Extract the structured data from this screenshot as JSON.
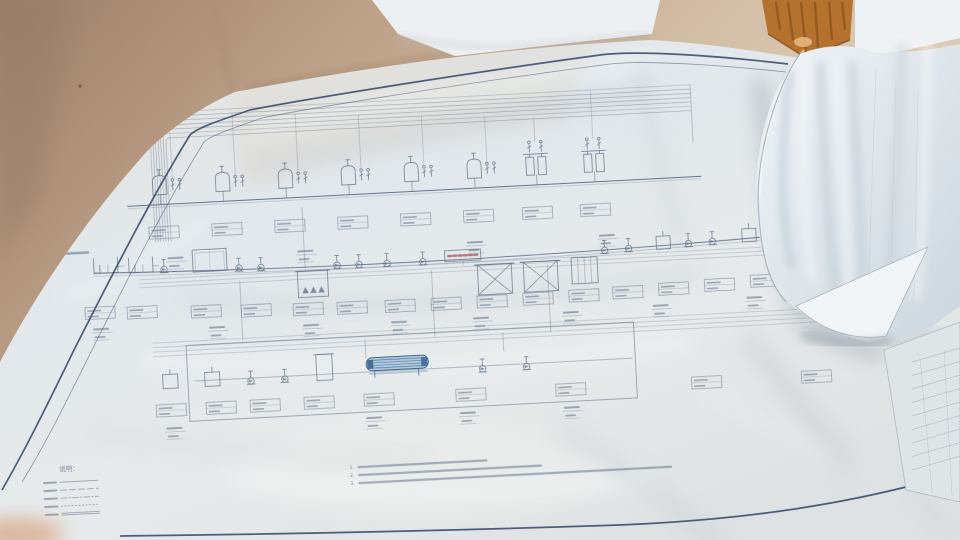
{
  "scene": {
    "description": "Photograph of a large process-flow blueprint (wastewater treatment PFD) spread on a tan surface, with folded drawing sheets draped on the right side",
    "colors": {
      "wall-dark": "#9c7f69",
      "wall-light": "#e2d2bc",
      "wood-patch": "#b5722e",
      "paper": "#e4e9ec",
      "paper-shadow": "#b9c4cc",
      "border-navy": "#3d4e6e",
      "ink": "#5a6a82",
      "accent-red": "#b05454",
      "accent-blue": "#2e5c8a",
      "machine-fill": "#a9c6db",
      "drape-paper": "#e9eef2",
      "title-sheet": "#dfe4e7"
    }
  },
  "legend": {
    "header": "说明：",
    "items": [
      {
        "label_legible": false,
        "line_style": "solid"
      },
      {
        "label_legible": false,
        "line_style": "dashed"
      },
      {
        "label_legible": false,
        "line_style": "dash-dot"
      },
      {
        "label_legible": false,
        "line_style": "dotted"
      },
      {
        "label_legible": false,
        "line_style": "double"
      }
    ]
  },
  "notes": {
    "items": [
      {
        "number": "1.",
        "length": 128
      },
      {
        "number": "2.",
        "length": 182
      },
      {
        "number": "3.",
        "length": 312
      }
    ]
  },
  "title_block": {
    "row_count": 9
  },
  "diagram": {
    "rotation_deg": -3,
    "top_row": {
      "baseline": 178,
      "units": [
        {
          "x": 158,
          "type": "dome"
        },
        {
          "x": 221,
          "type": "dome"
        },
        {
          "x": 284,
          "type": "dome"
        },
        {
          "x": 347,
          "type": "dome"
        },
        {
          "x": 410,
          "type": "dome"
        },
        {
          "x": 473,
          "type": "dome"
        },
        {
          "x": 532,
          "type": "columns"
        },
        {
          "x": 590,
          "type": "columns"
        }
      ],
      "underline_labels_x": [
        168,
        298,
        468,
        600
      ],
      "header_pipes": {
        "count": 7,
        "y": 96,
        "gap": 4.3,
        "x2": 700,
        "corner_x": 158,
        "corner_gap": 2.6,
        "y_bottom": 225
      },
      "main_line_y": 188
    },
    "mid_row": {
      "baseline": 252,
      "elements": [
        {
          "x": 58,
          "type": "microtext"
        },
        {
          "x": 95,
          "type": "basin"
        },
        {
          "x": 130,
          "type": "basin"
        },
        {
          "x": 165,
          "type": "pump"
        },
        {
          "x": 194,
          "type": "recttank"
        },
        {
          "x": 240,
          "type": "pump"
        },
        {
          "x": 262,
          "type": "pump"
        },
        {
          "x": 298,
          "type": "aeration"
        },
        {
          "x": 338,
          "type": "pump"
        },
        {
          "x": 360,
          "type": "pump"
        },
        {
          "x": 388,
          "type": "pump"
        },
        {
          "x": 424,
          "type": "pump"
        },
        {
          "x": 446,
          "type": "redbox"
        },
        {
          "x": 478,
          "type": "xtank"
        },
        {
          "x": 524,
          "type": "xtank"
        },
        {
          "x": 572,
          "type": "stripetank"
        },
        {
          "x": 606,
          "type": "pump"
        },
        {
          "x": 630,
          "type": "pump"
        },
        {
          "x": 658,
          "type": "tanksm"
        },
        {
          "x": 690,
          "type": "pump"
        },
        {
          "x": 714,
          "type": "pump"
        },
        {
          "x": 744,
          "type": "tanksm"
        },
        {
          "x": 776,
          "type": "pump"
        },
        {
          "x": 800,
          "type": "pump"
        },
        {
          "x": 824,
          "type": "tanksm"
        }
      ],
      "label_boxes_x": [
        84,
        126,
        190,
        240,
        292,
        336,
        384,
        430,
        476,
        522,
        568,
        612,
        658,
        704,
        750,
        798
      ],
      "underline_labels_x": [
        90,
        206,
        300,
        388,
        470,
        560,
        650,
        744,
        806
      ]
    },
    "bottom_row": {
      "baseline": 372,
      "enclosure": {
        "x": 183,
        "y": 330,
        "w": 448,
        "h": 76
      },
      "elements": [
        {
          "x": 158,
          "type": "tanksm"
        },
        {
          "x": 200,
          "type": "tanksm"
        },
        {
          "x": 246,
          "type": "pump"
        },
        {
          "x": 280,
          "type": "pump"
        },
        {
          "x": 312,
          "type": "tanktall"
        },
        {
          "x": 362,
          "type": "bluemachine"
        },
        {
          "x": 478,
          "type": "pump"
        },
        {
          "x": 522,
          "type": "pump"
        }
      ],
      "label_boxes_x": [
        150,
        200,
        244,
        298,
        358,
        450,
        550,
        686,
        796
      ],
      "underline_labels_x": [
        158,
        358,
        452,
        556
      ]
    },
    "inter_pipes": [
      {
        "y": 262,
        "x1": 140,
        "x2": 838,
        "count": 3,
        "gap": 4
      },
      {
        "y": 326,
        "x1": 150,
        "x2": 832,
        "count": 4,
        "gap": 4.5
      }
    ],
    "verticals": [
      [
        240,
        268,
        328
      ],
      [
        432,
        268,
        334
      ],
      [
        548,
        268,
        336
      ],
      [
        306,
        198,
        260
      ],
      [
        833,
        150,
        260
      ],
      [
        700,
        96,
        154
      ],
      [
        362,
        334,
        352
      ],
      [
        500,
        334,
        352
      ]
    ]
  }
}
